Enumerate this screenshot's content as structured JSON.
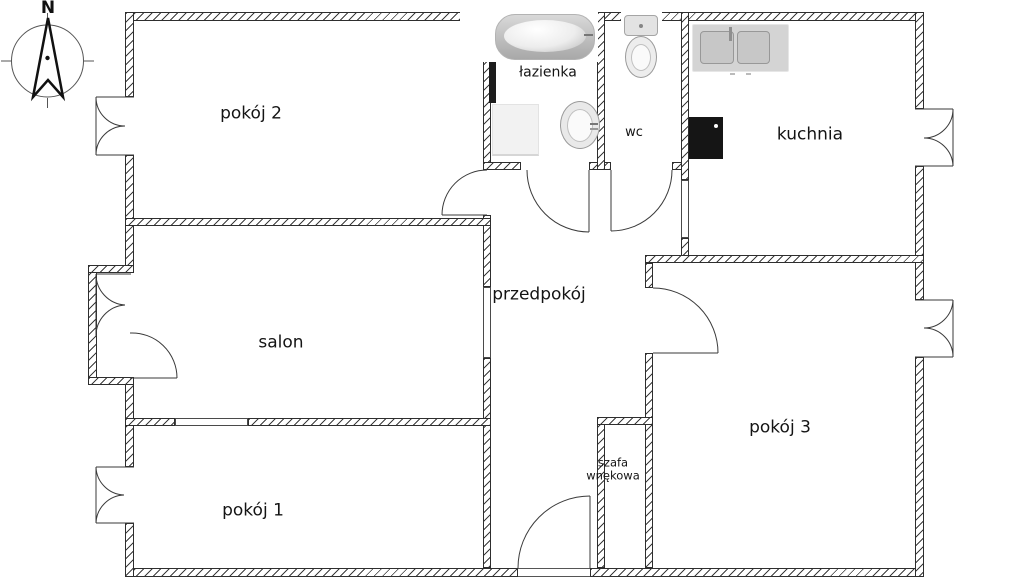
{
  "plan_title": "apartment-floor-plan",
  "compass": {
    "north_label": "N"
  },
  "rooms": {
    "pokoj2": {
      "label": "pokój 2"
    },
    "lazienka": {
      "label": "łazienka"
    },
    "wc": {
      "label": "wc"
    },
    "kuchnia": {
      "label": "kuchnia"
    },
    "salon": {
      "label": "salon"
    },
    "przedpokoj": {
      "label": "przedpokój"
    },
    "pokoj3": {
      "label": "pokój 3"
    },
    "pokoj1": {
      "label": "pokój 1"
    },
    "szafa": {
      "label_line1": "szafa",
      "label_line2": "wnękowa"
    }
  },
  "colors": {
    "wall_line": "#2e2e2e",
    "fixture_gray": "#d4d4d4",
    "stove_black": "#151515",
    "background": "#ffffff"
  }
}
